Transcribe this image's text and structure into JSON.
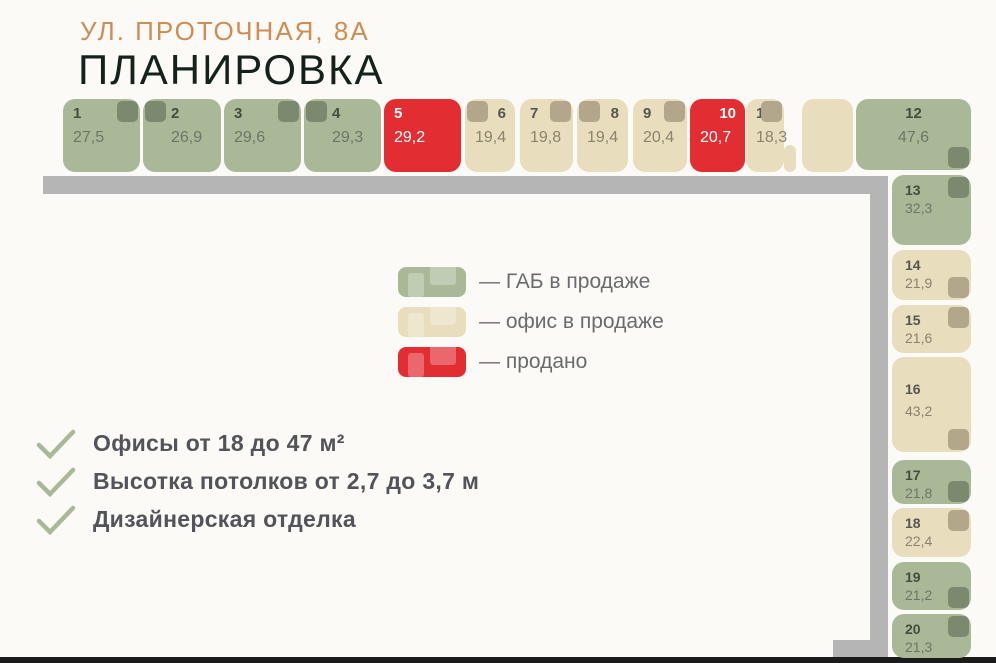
{
  "header": {
    "address": "УЛ. ПРОТОЧНАЯ, 8А",
    "title": "ПЛАНИРОВКА"
  },
  "legend": {
    "items": [
      {
        "key": "gab",
        "label": "— ГАБ в продаже",
        "color": "#a9b998"
      },
      {
        "key": "office",
        "label": "— офис в продаже",
        "color": "#e8ddbc"
      },
      {
        "key": "sold",
        "label": "— продано",
        "color": "#e22d32"
      }
    ]
  },
  "features": {
    "items": [
      "Офисы от 18 до 47 м²",
      "Высотка потолков от 2,7 до 3,7 м",
      "Дизайнерская отделка"
    ]
  },
  "colors": {
    "gab": "#a9b998",
    "office": "#e8ddbc",
    "sold": "#e22d32",
    "marker_gab": "#7b8a6e",
    "marker_office": "#b2a68b",
    "wall": "#b5b5b5",
    "accent": "#d08c52",
    "check": "#a8b996"
  },
  "units": [
    {
      "n": "1",
      "area": "27,5",
      "status": "gab",
      "marker": "tr",
      "x": 63,
      "y": 99,
      "w": 77,
      "h": 73
    },
    {
      "n": "2",
      "area": "26,9",
      "status": "gab",
      "marker": "tl",
      "indent": true,
      "x": 143,
      "y": 99,
      "w": 78,
      "h": 73
    },
    {
      "n": "3",
      "area": "29,6",
      "status": "gab",
      "marker": "tr",
      "x": 224,
      "y": 99,
      "w": 77,
      "h": 73
    },
    {
      "n": "4",
      "area": "29,3",
      "status": "gab",
      "marker": "tl",
      "indent": true,
      "x": 304,
      "y": 99,
      "w": 77,
      "h": 73
    },
    {
      "n": "5",
      "area": "29,2",
      "status": "sold",
      "marker": null,
      "x": 384,
      "y": 99,
      "w": 77,
      "h": 73
    },
    {
      "n": "6",
      "area": "19,4",
      "status": "office",
      "marker": "tl",
      "align": "right",
      "x": 465,
      "y": 99,
      "w": 50,
      "h": 73
    },
    {
      "n": "7",
      "area": "19,8",
      "status": "office",
      "marker": "tr",
      "x": 520,
      "y": 99,
      "w": 53,
      "h": 73
    },
    {
      "n": "8",
      "area": "19,4",
      "status": "office",
      "marker": "tl",
      "align": "right",
      "x": 577,
      "y": 99,
      "w": 51,
      "h": 73
    },
    {
      "n": "9",
      "area": "20,4",
      "status": "office",
      "marker": "tr",
      "x": 633,
      "y": 99,
      "w": 54,
      "h": 73
    },
    {
      "n": "10",
      "area": "20,7",
      "status": "sold",
      "marker": null,
      "align": "right",
      "x": 690,
      "y": 99,
      "w": 55,
      "h": 73
    },
    {
      "n": "11",
      "area": "18,3",
      "status": "office",
      "marker": "tr",
      "x": 746,
      "y": 99,
      "w": 38,
      "h": 73
    },
    {
      "n": null,
      "area": null,
      "status": "office",
      "marker": null,
      "frag": true,
      "x": 784,
      "y": 145,
      "w": 12,
      "h": 27
    },
    {
      "n": null,
      "area": null,
      "status": "office",
      "marker": null,
      "x": 802,
      "y": 99,
      "w": 51,
      "h": 73
    },
    {
      "n": "12",
      "area": "47,6",
      "status": "gab",
      "marker": "br",
      "align": "center",
      "x": 856,
      "y": 99,
      "w": 115,
      "h": 71
    },
    {
      "n": "13",
      "area": "32,3",
      "status": "gab",
      "marker": "tr",
      "col": true,
      "x": 892,
      "y": 175,
      "w": 79,
      "h": 70
    },
    {
      "n": "14",
      "area": "21,9",
      "status": "office",
      "marker": "br",
      "col": true,
      "x": 892,
      "y": 250,
      "w": 79,
      "h": 50
    },
    {
      "n": "15",
      "area": "21,6",
      "status": "office",
      "marker": "tr",
      "col": true,
      "x": 892,
      "y": 305,
      "w": 79,
      "h": 48
    },
    {
      "n": "16",
      "area": "43,2",
      "status": "office",
      "marker": "br",
      "col": true,
      "pad": true,
      "x": 892,
      "y": 357,
      "w": 79,
      "h": 95
    },
    {
      "n": "17",
      "area": "21,8",
      "status": "gab",
      "marker": "br",
      "col": true,
      "x": 892,
      "y": 460,
      "w": 79,
      "h": 44
    },
    {
      "n": "18",
      "area": "22,4",
      "status": "office",
      "marker": "tr",
      "col": true,
      "x": 892,
      "y": 508,
      "w": 79,
      "h": 49
    },
    {
      "n": "19",
      "area": "21,2",
      "status": "gab",
      "marker": "br",
      "col": true,
      "x": 892,
      "y": 562,
      "w": 79,
      "h": 48
    },
    {
      "n": "20",
      "area": "21,3",
      "status": "gab",
      "marker": "tr",
      "col": true,
      "x": 892,
      "y": 614,
      "w": 79,
      "h": 44
    }
  ]
}
